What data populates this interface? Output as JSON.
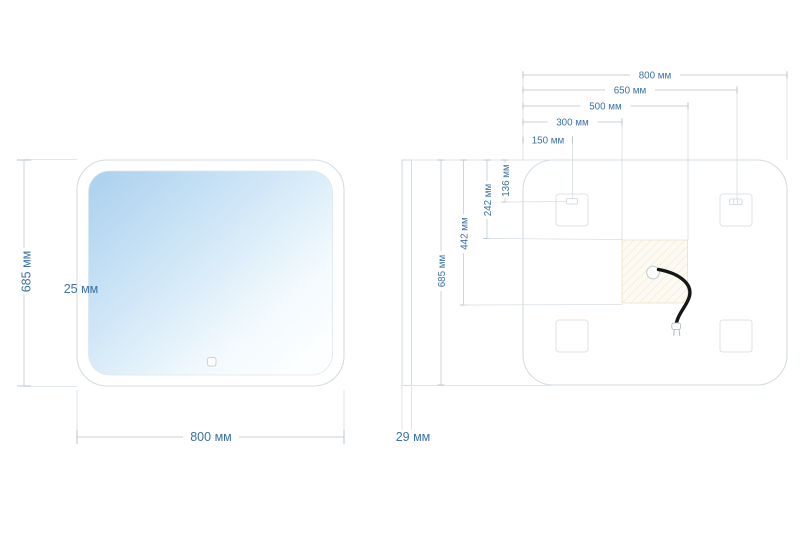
{
  "front_view": {
    "height_label": "685 мм",
    "edge_inset_label": "25 мм",
    "width_label": "800 мм"
  },
  "side_view": {
    "depth_label": "29 мм"
  },
  "back_view": {
    "top_dimensions": {
      "w800": "800 мм",
      "w650": "650 мм",
      "w500": "500 мм",
      "w300": "300 мм",
      "w150": "150 мм"
    },
    "side_dimensions": {
      "h685": "685 мм",
      "h442": "442 мм",
      "h242": "242 мм",
      "h136": "136 мм"
    }
  },
  "colors": {
    "dimension_text": "#3b72a6",
    "dimension_line": "#c6d1d8",
    "object_outline": "#d5dde2",
    "glass_gradient_start": "#aed2ee",
    "hatch_line": "#e3cfa4",
    "power_zone_bg": "#fdfaf3",
    "cable": "#161616"
  }
}
